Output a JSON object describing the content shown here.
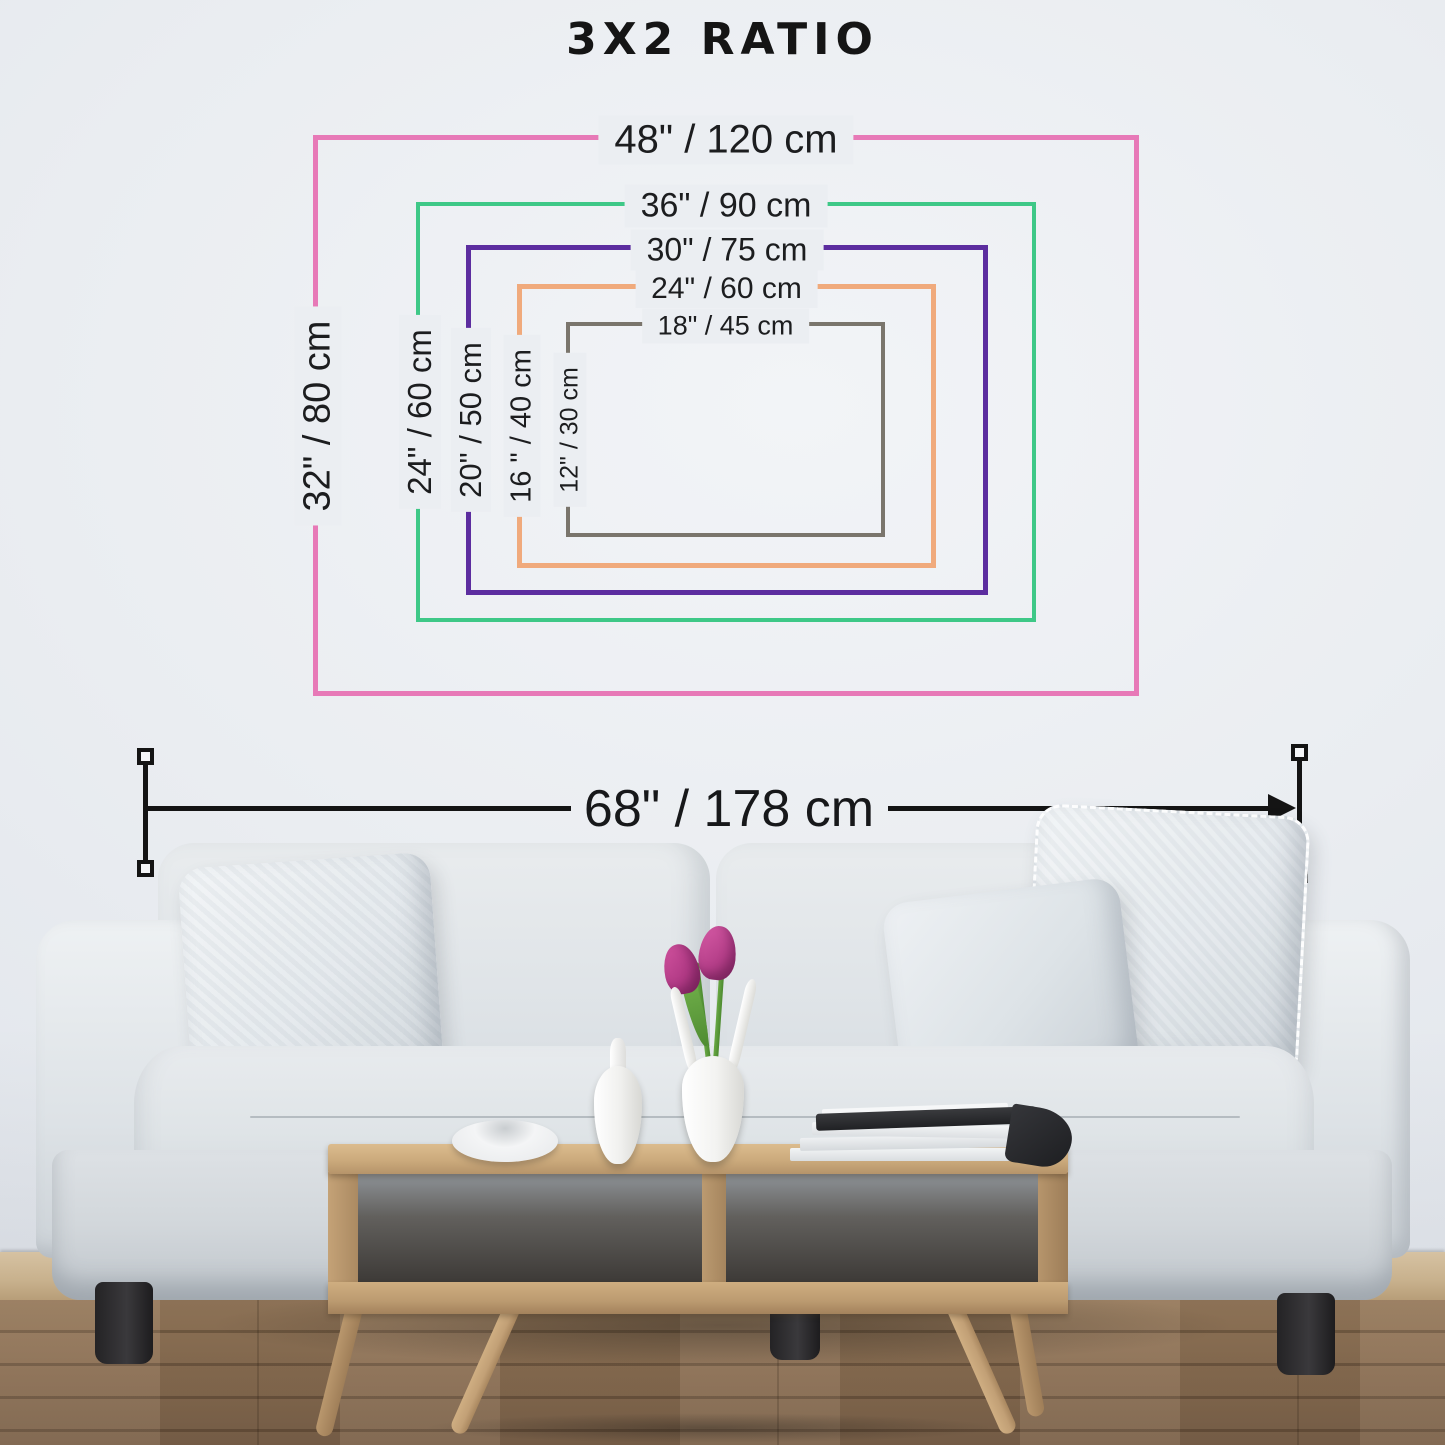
{
  "title": "3X2 RATIO",
  "frame_sizes": [
    {
      "name": "48x32",
      "top_label": "48\" / 120 cm",
      "side_label": "32\" / 80 cm",
      "color": "#e779b7"
    },
    {
      "name": "36x24",
      "top_label": "36\" / 90 cm",
      "side_label": "24\" / 60 cm",
      "color": "#3ec887"
    },
    {
      "name": "30x20",
      "top_label": "30\" / 75 cm",
      "side_label": "20\" / 50 cm",
      "color": "#5c2d9f"
    },
    {
      "name": "24x16",
      "top_label": "24\" / 60 cm",
      "side_label": "16 \" / 40 cm",
      "color": "#f0aa7c"
    },
    {
      "name": "18x12",
      "top_label": "18\" / 45 cm",
      "side_label": "12\" / 30 cm",
      "color": "#7a756c"
    }
  ],
  "sofa_measurement": {
    "label": "68\" / 178 cm"
  },
  "colors": {
    "wall": "#eaedf1",
    "measurement_line": "#141414",
    "floor_wood": "#8a6e52",
    "table_wood": "#c9a87b",
    "sofa_fabric": "#dfe4e8",
    "tulip_pink": "#b53f89"
  }
}
